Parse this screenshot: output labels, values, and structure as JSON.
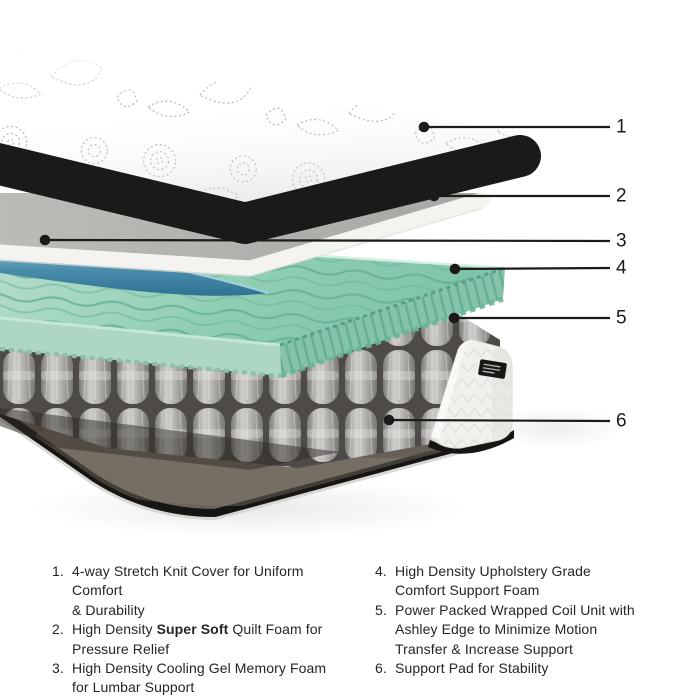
{
  "colors": {
    "background": "#ffffff",
    "callout_line": "#1d1b19",
    "legend_text": "#282421",
    "mattress_band": "#1b1a19",
    "foam_grey_top": "#b3b2af",
    "foam_white_edge": "#f4f3f0",
    "gel_blue": "#4a8dab",
    "memory_foam_green": "#8ecdb3",
    "coil_grey": "#bbbab7",
    "wedge_white": "#f1f0ed",
    "support_pad_brown": "#6b6359"
  },
  "diagram": {
    "callouts": [
      {
        "num": "1",
        "dot": [
          424,
          127
        ],
        "end_x": 610,
        "label_y": 127
      },
      {
        "num": "2",
        "dot": [
          434,
          196
        ],
        "end_x": 610,
        "label_y": 196
      },
      {
        "num": "3",
        "dot": [
          45,
          240
        ],
        "end_x": 610,
        "label_y": 241
      },
      {
        "num": "4",
        "dot": [
          455,
          269
        ],
        "end_x": 610,
        "label_y": 268
      },
      {
        "num": "5",
        "dot": [
          454,
          318
        ],
        "end_x": 610,
        "label_y": 318
      },
      {
        "num": "6",
        "dot": [
          389,
          420
        ],
        "end_x": 610,
        "label_y": 421
      }
    ],
    "label_x": 616
  },
  "legend": {
    "columns": [
      {
        "items": [
          {
            "num": "1.",
            "lines": [
              [
                {
                  "t": "4-way Stretch Knit Cover for Uniform Comfort"
                }
              ],
              [
                {
                  "t": "& Durability"
                }
              ]
            ]
          },
          {
            "num": "2.",
            "lines": [
              [
                {
                  "t": "High Density "
                },
                {
                  "t": "Super Soft",
                  "b": true
                },
                {
                  "t": " Quilt Foam for"
                }
              ],
              [
                {
                  "t": "Pressure Relief"
                }
              ]
            ]
          },
          {
            "num": "3.",
            "lines": [
              [
                {
                  "t": "High Density Cooling Gel Memory Foam"
                }
              ],
              [
                {
                  "t": "for Lumbar Support"
                }
              ]
            ]
          }
        ]
      },
      {
        "items": [
          {
            "num": "4.",
            "lines": [
              [
                {
                  "t": "High Density Upholstery Grade"
                }
              ],
              [
                {
                  "t": "Comfort Support Foam"
                }
              ]
            ]
          },
          {
            "num": "5.",
            "lines": [
              [
                {
                  "t": "Power Packed Wrapped Coil Unit with"
                }
              ],
              [
                {
                  "t": "Ashley Edge to Minimize Motion"
                }
              ],
              [
                {
                  "t": "Transfer & Increase Support"
                }
              ]
            ]
          },
          {
            "num": "6.",
            "lines": [
              [
                {
                  "t": "Support Pad for Stability"
                }
              ]
            ]
          }
        ]
      }
    ]
  }
}
